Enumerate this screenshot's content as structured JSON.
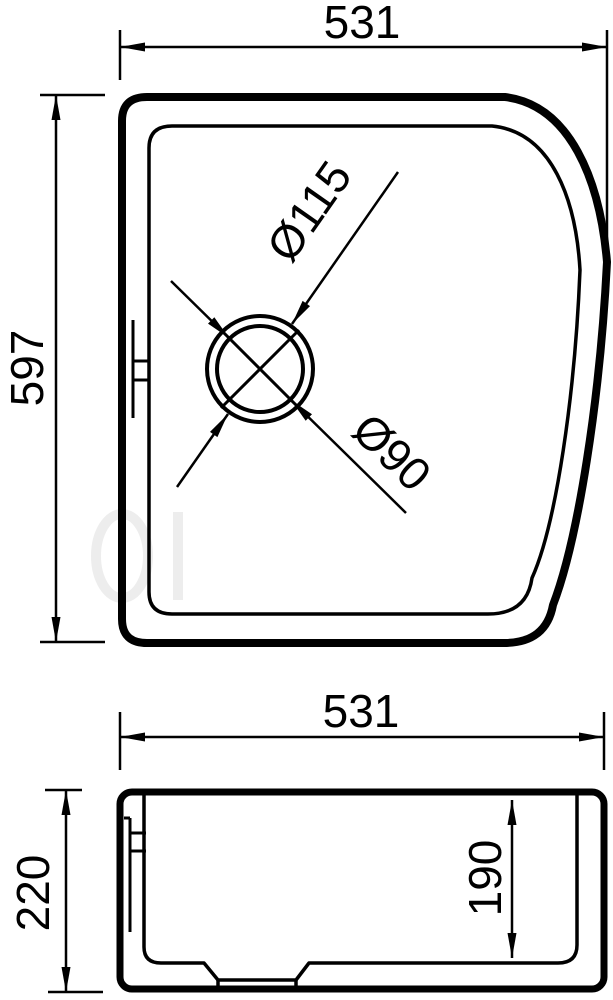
{
  "colors": {
    "line": "#000000",
    "background": "#ffffff"
  },
  "views": {
    "top": {
      "name": "top view",
      "dim_width": "531",
      "dim_height": "597",
      "dim_drain_outer": "Ø115",
      "dim_drain_inner": "Ø90"
    },
    "section": {
      "name": "section view",
      "dim_width": "531",
      "dim_height": "220",
      "dim_inner_depth": "190"
    }
  }
}
